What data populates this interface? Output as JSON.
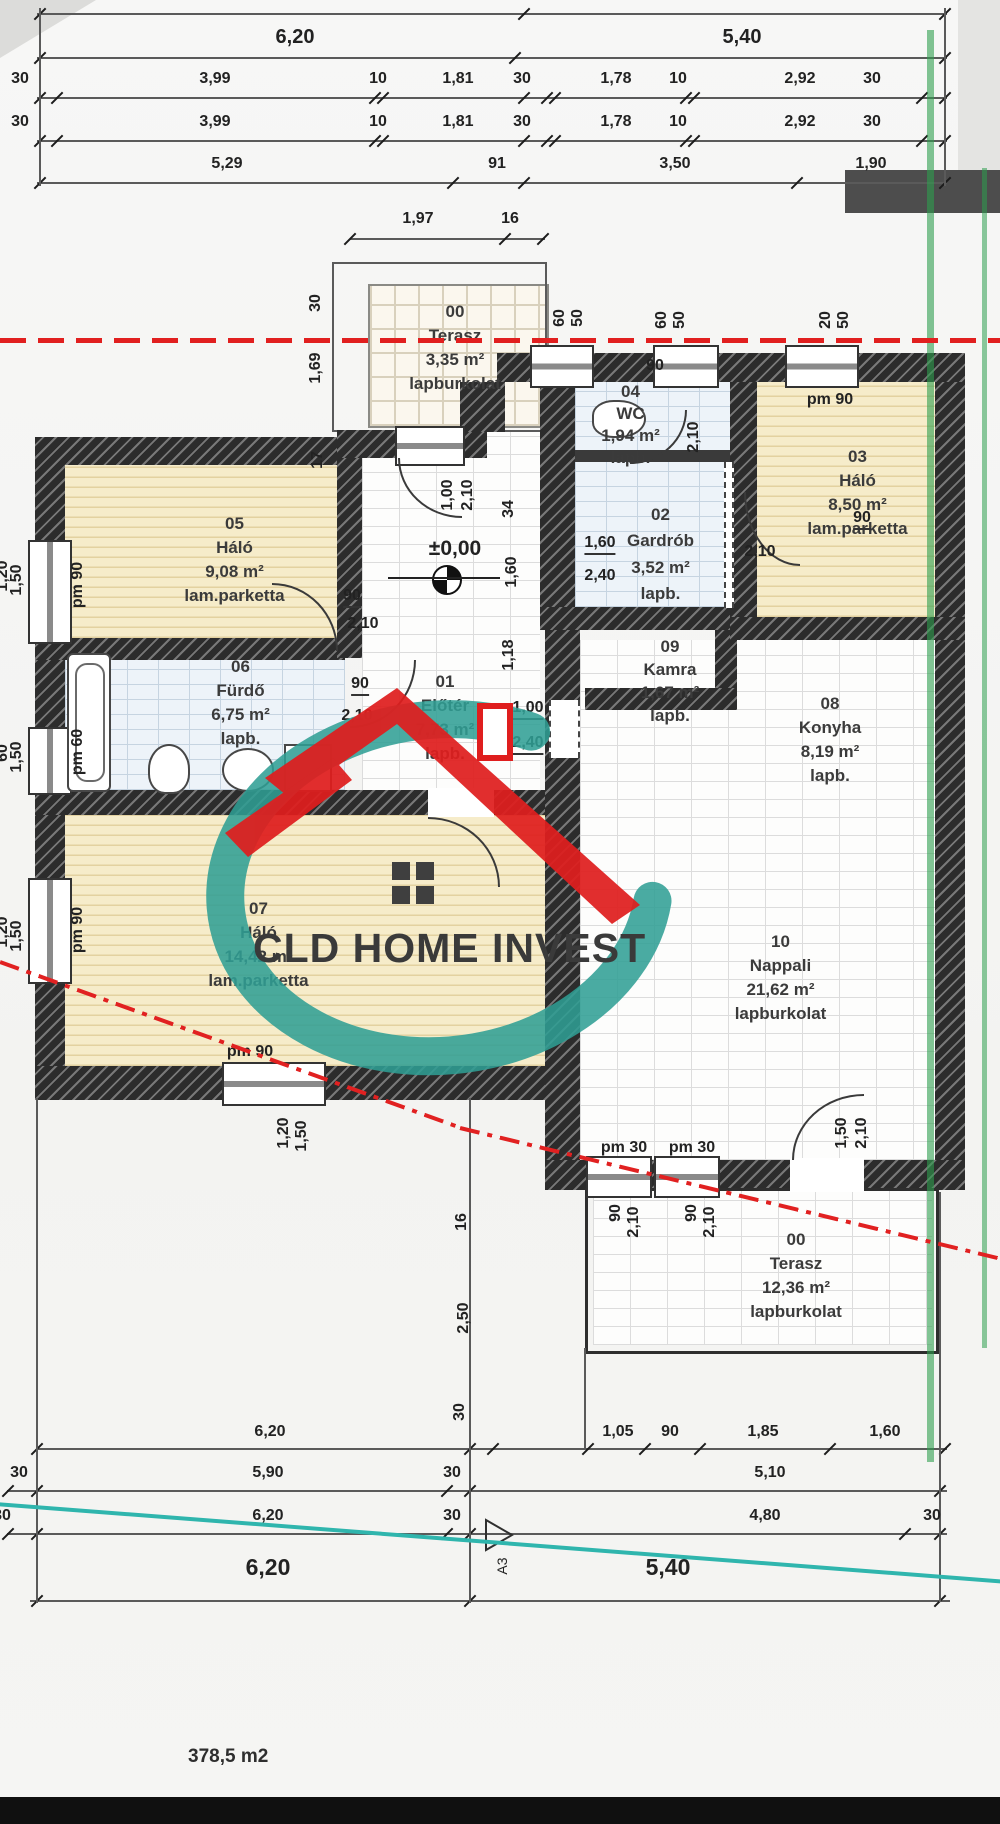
{
  "watermark": {
    "text": "CLD HOME INVEST",
    "roof_color": "#df1e1e",
    "swoosh_color": "#2f9e94"
  },
  "meta": {
    "total_area": "378,5 m2",
    "sheet_marker": "A3",
    "level_mark": "±0,00"
  },
  "rooms": {
    "terasz_top": {
      "num": "00",
      "name": "Terasz",
      "area": "3,35 m²",
      "floor": "lapburkolat"
    },
    "halo5": {
      "num": "05",
      "name": "Háló",
      "area": "9,08 m²",
      "floor": "lam.parketta"
    },
    "furdo": {
      "num": "06",
      "name": "Fürdő",
      "area": "6,75 m²",
      "floor": "lapb."
    },
    "eloter": {
      "num": "01",
      "name": "Előtér",
      "area": "7,73 m²",
      "floor": "lapb."
    },
    "wc": {
      "num": "04",
      "name": "WC",
      "area": "1,94 m²",
      "floor": "lapb."
    },
    "gardrob": {
      "num": "02",
      "name": "Gardrób",
      "area": "3,52 m²",
      "floor": "lapb."
    },
    "halo3": {
      "num": "03",
      "name": "Háló",
      "area": "8,50 m²",
      "floor": "lam.parketta"
    },
    "kamra": {
      "num": "09",
      "name": "Kamra",
      "area": "1,67 m²",
      "floor": "lapb."
    },
    "konyha": {
      "num": "08",
      "name": "Konyha",
      "area": "8,19 m²",
      "floor": "lapb."
    },
    "halo7": {
      "num": "07",
      "name": "Háló",
      "area": "14,42 m²",
      "floor": "lam.parketta"
    },
    "nappali": {
      "num": "10",
      "name": "Nappali",
      "area": "21,62 m²",
      "floor": "lapburkolat"
    },
    "terasz_bottom": {
      "num": "00",
      "name": "Terasz",
      "area": "12,36 m²",
      "floor": "lapburkolat"
    }
  },
  "dims": {
    "top": {
      "r0": [
        "6,20",
        "5,40"
      ],
      "r1": [
        "30",
        "3,99",
        "10",
        "1,81",
        "30",
        "1,78",
        "10",
        "2,92",
        "30"
      ],
      "r2": [
        "30",
        "3,99",
        "10",
        "1,81",
        "30",
        "1,78",
        "10",
        "2,92",
        "30"
      ],
      "r3": [
        "5,29",
        "91",
        "3,50",
        "1,90"
      ],
      "terrace": [
        "1,97",
        "16"
      ]
    },
    "bottom": {
      "r1": [
        "6,20",
        "30",
        "1,05",
        "90",
        "1,85",
        "1,60"
      ],
      "r2": [
        "30",
        "5,90",
        "30",
        "5,10"
      ],
      "r3": [
        "30",
        "6,20",
        "30",
        "4,80",
        "30"
      ],
      "r4": [
        "6,20",
        "5,40"
      ]
    }
  },
  "t": {
    "d30": "30",
    "d10": "10",
    "d16": "16",
    "d17": "17",
    "d20": "20",
    "d34": "34",
    "d50": "50",
    "d60": "60",
    "d90": "90",
    "d91": "91",
    "d100": "1,00",
    "d101": "1,01",
    "d105": "1,05",
    "d118": "1,18",
    "d120": "1,20",
    "d150": "1,50",
    "d160": "1,60",
    "d169": "1,69",
    "d178": "1,78",
    "d181": "1,81",
    "d185": "1,85",
    "d190": "1,90",
    "d197": "1,97",
    "d210": "2,10",
    "d240": "2,40",
    "d250": "2,50",
    "d292": "2,92",
    "d350": "3,50",
    "d399": "3,99",
    "d480": "4,80",
    "d510": "5,10",
    "d529": "5,29",
    "d540": "5,40",
    "d590": "5,90",
    "d620": "6,20",
    "pm90": "pm 90",
    "pm60": "pm 60",
    "pm30": "pm 30"
  }
}
